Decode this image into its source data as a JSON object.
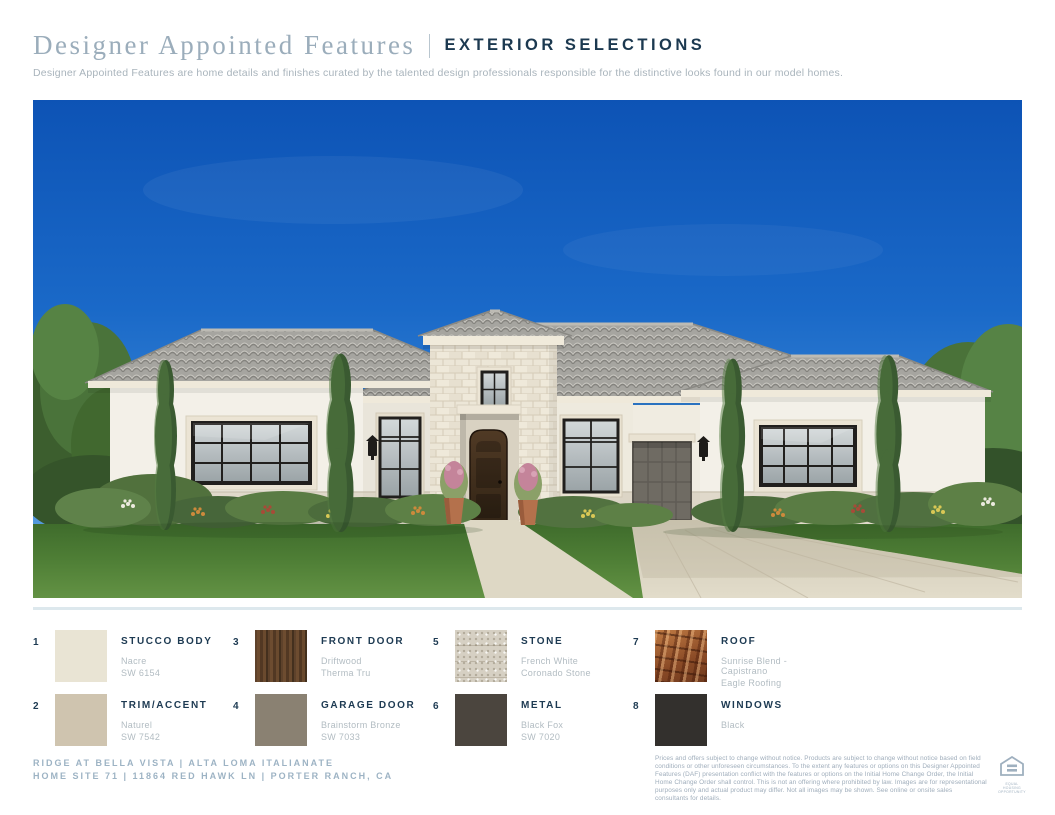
{
  "header": {
    "title_serif": "Designer Appointed Features",
    "title_caps": "EXTERIOR SELECTIONS",
    "subtitle": "Designer Appointed Features are home details and finishes curated by the talented design professionals responsible for the distinctive looks found in our model homes."
  },
  "hero": {
    "description": "Front exterior rendering of a single-story Italianate stucco home with stone entry tower, tile roof, black-framed windows, garage and landscaped yard"
  },
  "selections": [
    {
      "num": "1",
      "label": "STUCCO BODY",
      "line1": "Nacre",
      "line2": "SW 6154",
      "swatch_type": "solid",
      "swatch": "#e9e4d4"
    },
    {
      "num": "2",
      "label": "TRIM/ACCENT",
      "line1": "Naturel",
      "line2": "SW 7542",
      "swatch_type": "solid",
      "swatch": "#cfc4af"
    },
    {
      "num": "3",
      "label": "FRONT DOOR",
      "line1": "Driftwood",
      "line2": "Therma Tru",
      "swatch_type": "wood",
      "swatch": "#5d4129"
    },
    {
      "num": "4",
      "label": "GARAGE DOOR",
      "line1": "Brainstorm Bronze",
      "line2": "SW 7033",
      "swatch_type": "solid",
      "swatch": "#8a8172"
    },
    {
      "num": "5",
      "label": "STONE",
      "line1": "French White",
      "line2": "Coronado Stone",
      "swatch_type": "stone",
      "swatch": "#d6d0c3"
    },
    {
      "num": "6",
      "label": "METAL",
      "line1": "Black Fox",
      "line2": "SW 7020",
      "swatch_type": "solid",
      "swatch": "#4b453e"
    },
    {
      "num": "7",
      "label": "ROOF",
      "line1": "Sunrise Blend - Capistrano",
      "line2": "Eagle Roofing",
      "swatch_type": "roof",
      "swatch": "#9c5a30"
    },
    {
      "num": "8",
      "label": "WINDOWS",
      "line1": "Black",
      "line2": "",
      "swatch_type": "solid",
      "swatch": "#33302d"
    }
  ],
  "footer": {
    "community_line1": "RIDGE AT BELLA VISTA | ALTA LOMA ITALIANATE",
    "community_line2": "HOME SITE 71 | 11864 RED HAWK LN | PORTER RANCH, CA",
    "disclaimer": "Prices and offers subject to change without notice. Products are subject to change without notice based on field conditions or other unforeseen circumstances. To the extent any features or options on this Designer Appointed Features (DAF) presentation conflict with the features or options on the Initial Home Change Order, the Initial Home Change Order shall control. This is not an offering where prohibited by law. Images are for representational purposes only and actual product may differ. Not all images may be shown. See online or onsite sales consultants for details.",
    "eho_label": "EQUAL HOUSING OPPORTUNITY"
  },
  "colors": {
    "navy": "#1d3a52",
    "title_serif": "#9badbb",
    "muted_gray": "#b2bcc2",
    "community_blue": "#9db3c4",
    "divider": "#dde8ed",
    "sky_blue": "#1464c8"
  }
}
